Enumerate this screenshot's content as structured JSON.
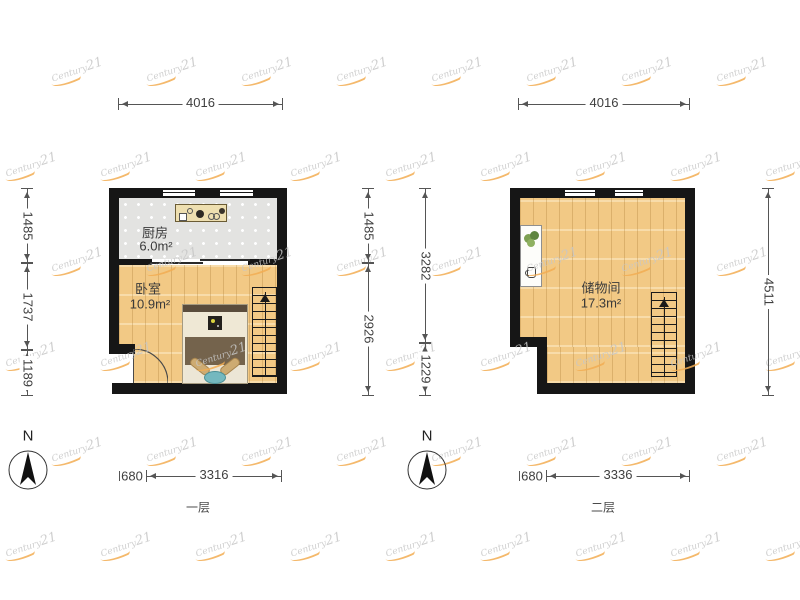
{
  "watermark": {
    "brand_prefix": "Century",
    "brand_suffix": "21"
  },
  "compass": {
    "label": "N"
  },
  "floor1": {
    "name": "一层",
    "rooms": {
      "kitchen": {
        "label": "厨房",
        "area": "6.0m²"
      },
      "bedroom": {
        "label": "卧室",
        "area": "10.9m²"
      }
    },
    "dims": {
      "top": "4016",
      "left": [
        "1485",
        "1737",
        "1189"
      ],
      "right": [
        "1485",
        "2926"
      ],
      "bottom_offset": "680",
      "bottom": "3316"
    }
  },
  "floor2": {
    "name": "二层",
    "rooms": {
      "storage": {
        "label": "储物间",
        "area": "17.3m²"
      }
    },
    "dims": {
      "top": "4016",
      "left": [
        "3282",
        "1229"
      ],
      "right": [
        "4511"
      ],
      "bottom_offset": "680",
      "bottom": "3336"
    }
  }
}
